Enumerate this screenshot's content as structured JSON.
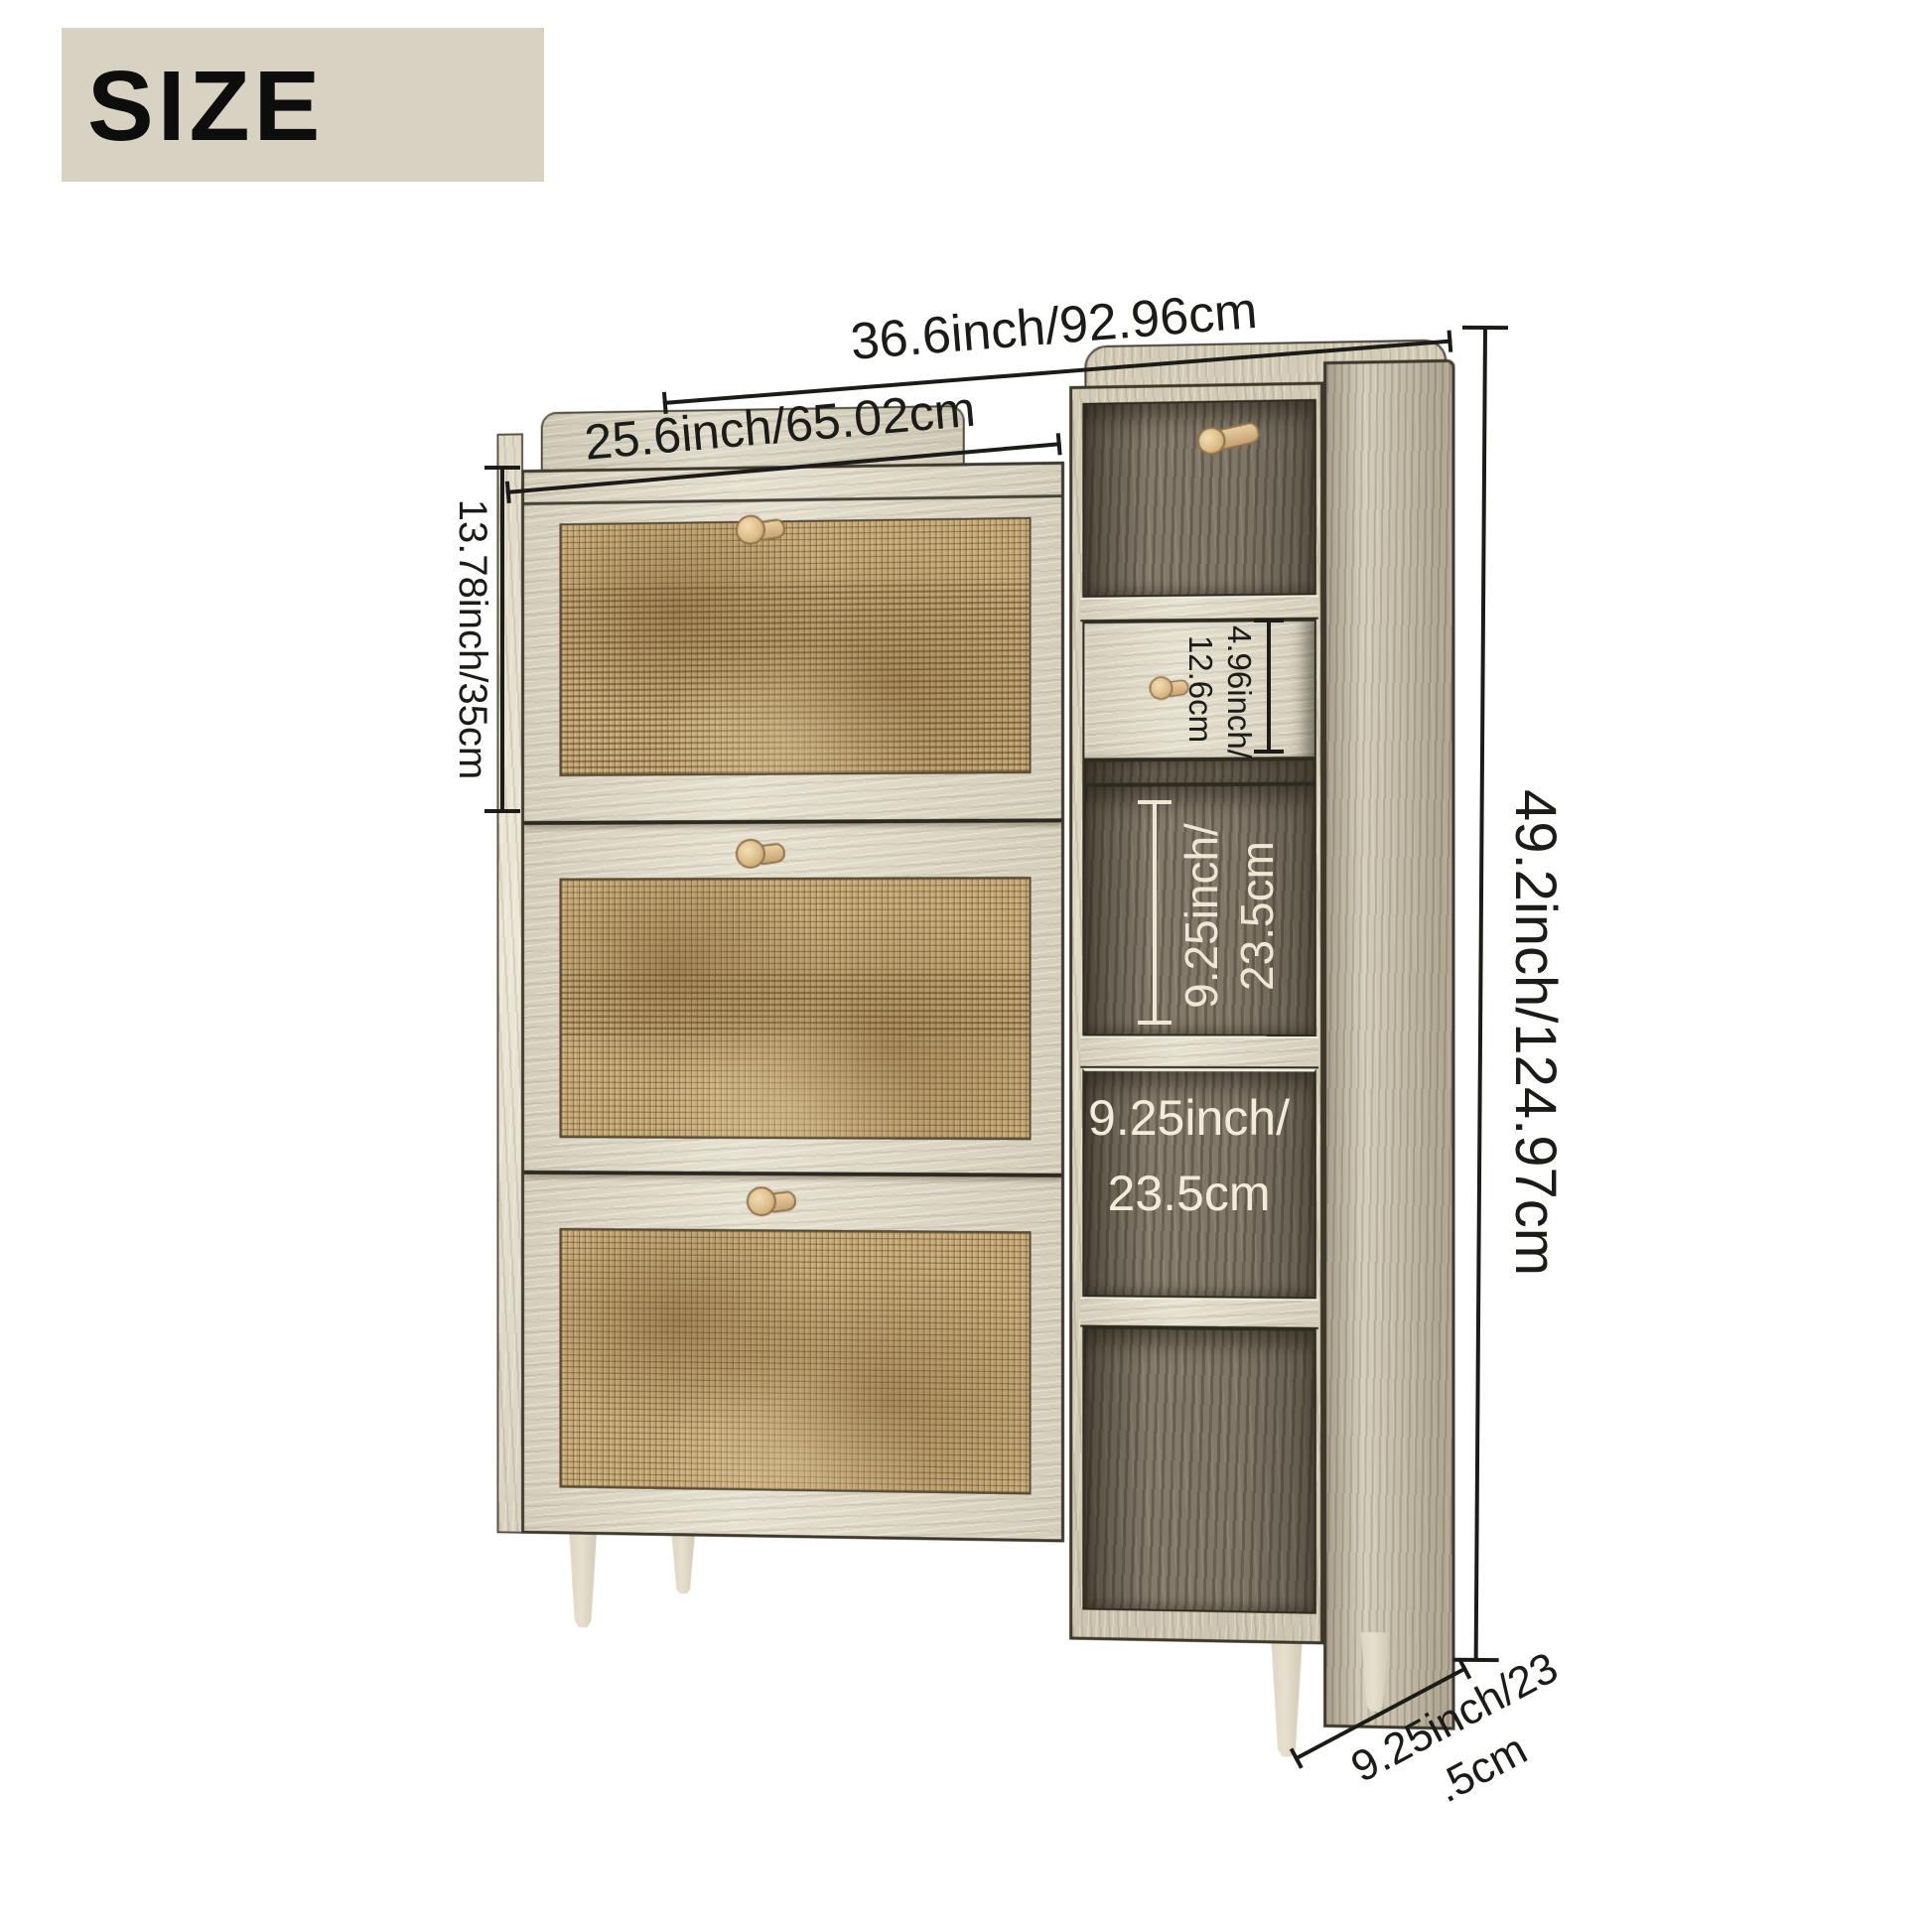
{
  "header": {
    "label": "SIZE"
  },
  "diagram": {
    "subject": "rattan shoe storage cabinet with flip doors, side drawer and open shelves",
    "dimensions": {
      "top_width": "36.6inch/92.96cm",
      "inner_width": "25.6inch/65.02cm",
      "flip_door_height": "13.78inch/35cm",
      "total_height": "49.2inch/124.97cm",
      "drawer_height_line1": "4.96inch/",
      "drawer_height_line2": "12.6cm",
      "side_shelf_height_line1": "9.25inch/",
      "side_shelf_height_line2": "23.5cm",
      "front_shelf_height_line1": "9.25inch/",
      "front_shelf_height_line2": "23.5cm",
      "depth_line1": "9.25inch/23",
      "depth_line2": ".5cm"
    },
    "icons": {
      "door_knob": "round wooden knob",
      "drawer_knob": "round wooden knob",
      "coat_hook": "wooden peg hook"
    },
    "colors": {
      "header_bg": "#d8d2c2",
      "dim_text_dark": "#1b1b18",
      "dim_text_light": "#efe7d3",
      "wood_cream": "#e2dcc8",
      "wood_side": "#cdc5af",
      "wood_interior": "#8a8172",
      "rattan": "#c4a876",
      "knob_wood": "#ddbd8b",
      "outline": "#3a342a",
      "background": "#ffffff"
    }
  }
}
